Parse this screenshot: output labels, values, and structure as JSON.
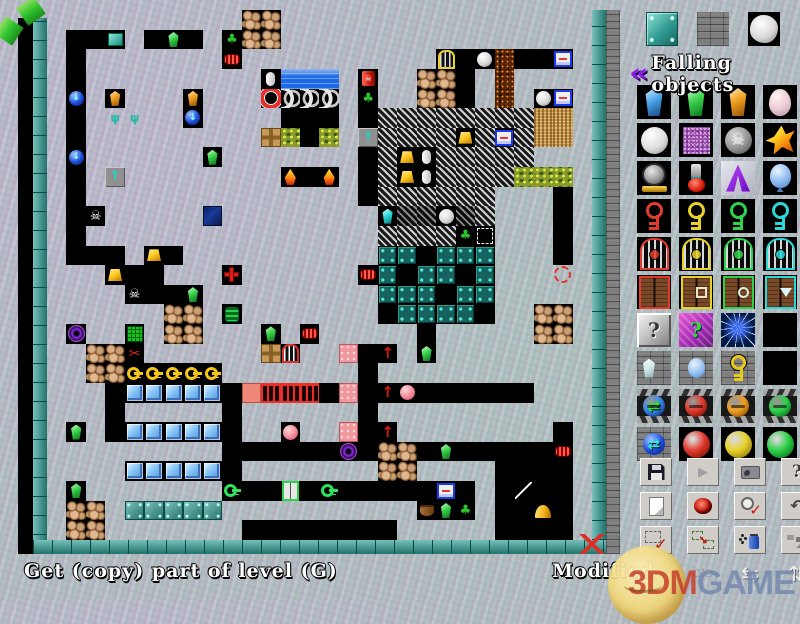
{
  "status_bar": {
    "left_text": "Get (copy) part of level (G)",
    "right_text": "Modified"
  },
  "watermark": {
    "brand_red": "3DM",
    "brand_blue": "GAME"
  },
  "palette": {
    "samples": [
      "steel-plate",
      "brick-wall",
      "white-boulder"
    ],
    "header": {
      "icon": "purple-double-chevron-icon",
      "icon_glyph": "«",
      "label": "Falling objects"
    },
    "items": [
      "gem-blue",
      "gem-green",
      "gem-orange",
      "egg-pink",
      "ball-white",
      "crystal-speckled",
      "ball-skull",
      "flame-orange",
      "bomb-gray",
      "potion",
      "arrow-purple",
      "balloon-blue",
      "key-red",
      "key-yellow",
      "key-green",
      "key-cyan",
      "gate-red",
      "gate-yellow",
      "gate-green",
      "gate-cyan",
      "door-red",
      "door-yellow",
      "door-green",
      "door-cyan",
      "question-gray",
      "question-purple",
      "sparkle-blue",
      "lava-a",
      "brick-gem",
      "brick-balloon",
      "brick-key",
      "lava-b",
      "hazard-ball-blue",
      "hazard-ball-red",
      "hazard-ball-orange",
      "hazard-ball-green",
      "brick-ball-blue",
      "ball-red",
      "ball-yellow",
      "ball-green"
    ],
    "glyphs": {
      "ball-skull": "☠",
      "question-gray": "?",
      "question-purple": "?",
      "hazard-ball-blue": "⇄",
      "brick-ball-blue": "⇄"
    }
  },
  "toolbar": {
    "buttons": [
      {
        "icon": "save"
      },
      {
        "icon": "play",
        "glyph": "▶"
      },
      {
        "icon": "capture"
      },
      {
        "icon": "help",
        "glyph": "?"
      },
      {
        "icon": "new"
      },
      {
        "icon": "bomb"
      },
      {
        "icon": "zoomcheck"
      },
      {
        "icon": "undo",
        "glyph": "↶"
      },
      {
        "icon": "selcheck"
      },
      {
        "icon": "copysel",
        "glyph": "↘"
      },
      {
        "icon": "spray"
      },
      {
        "icon": "tiles"
      },
      {
        "icon": "hidden",
        "flat": true
      },
      {
        "icon": "mirror",
        "glyph": "○|○",
        "flat": true
      },
      {
        "icon": "swaph",
        "glyph": "⇆",
        "flat": true
      },
      {
        "icon": "swapv",
        "glyph": "⇅",
        "flat": true
      }
    ]
  },
  "map": {
    "legend": {
      "#": "brick",
      ".": "empty",
      "=": "steel",
      "~": "hatch",
      "%": "hatchdark",
      "c": "panel",
      "m": "camo",
      "L": "lava",
      "F": "fuzz",
      "w": "water",
      "d": "waterdark",
      "n": "wave",
      "W": "whiteball",
      "b": "ballb",
      "g": "gemg",
      "o": "gemo",
      "t": "tealgem",
      "s": "skull",
      "G": "nug",
      "k": "keygold",
      "K": "keygreen",
      "i": "ice",
      "p": "plant",
      "q": "redcan",
      "r": "coil",
      "O": "ring",
      "v": "tv",
      "V": "monitor",
      "x": "crosstile",
      "T": "crosstile",
      "a": "cyanarrow",
      "u": "sprout",
      "+": "redplus",
      "Y": "cagey",
      "C": "cagew",
      "Z": "barrelg",
      "P": "portal",
      "E": "gridblock",
      "S": "scissors",
      "h": "pinkdot",
      "H": "salmon",
      "R": "redgate",
      "A": "uparrow",
      "e": "pinkball",
      "D": "doorg",
      "N": "capsule",
      "l": "laser",
      "J": "dome",
      "j": "pot",
      "Q": "dashbox",
      "?": "cursor",
      "B": "rock",
      "f": "fire"
    },
    "glyphs": {
      "skull": "☠",
      "plant": "♣",
      "sprout": "ψ",
      "cyanarrow": "↑",
      "uparrow": "↑",
      "scissors": "✂",
      "ballb": "↓",
      "redcan": "☠"
    },
    "rows": [
      "##########BB################",
      "#..v#.g.#pBB################",
      "#.#######r##########Y.WL..V#",
      "#.#########Nwww#q##BB.#L####",
      "#b#o###o###Onnn#p##BB.#L#WV#",
      "#.#uu##b####...#.~~~~~~~~FF#",
      "#.#########xm.m#a~~~~G~V~FF#",
      "#b######g#######.~GN~~~~~###",
      "#.#a########f.f#.~GN~~~~mmm#",
      "#.##############.~~~~~~###.#",
      "#.s#####d########t%%W%~###.#",
      "#.###############~~~~pQ###.#",
      "#...#G.##########cc.ccc###.#",
      "###G..###+######rc.cc.c###?#",
      "####s..g#########ccc.cc#####",
      "######BB#Z#######.cccc.##BB#",
      "#P##E#BB###g#r#####.#####BB#",
      "##BBS######TC##h.A#g########",
      "##BBkkkkk#######.###########",
      "###.iiiii.HRRR.h.Ae......###",
      "###.#####.######.###########",
      "#g#.iiiii.##e##h.A########.#",
      "#########......P.BB.g.....r#",
      "####iiiii.#######BB####....#",
      "#g#######K..D.K.....V.#.l..#",
      "#BB#=====##########jgp#..J.#",
      "#BB#######........#####....#"
    ]
  },
  "colors": {
    "border_teal": "#2f9f96",
    "wall_gray": "#7e7e7e",
    "corridor_black": "#000000",
    "background": "#b4bdc0",
    "status_text": "#ffffff",
    "chevron_purple": "#8a1ae8"
  }
}
